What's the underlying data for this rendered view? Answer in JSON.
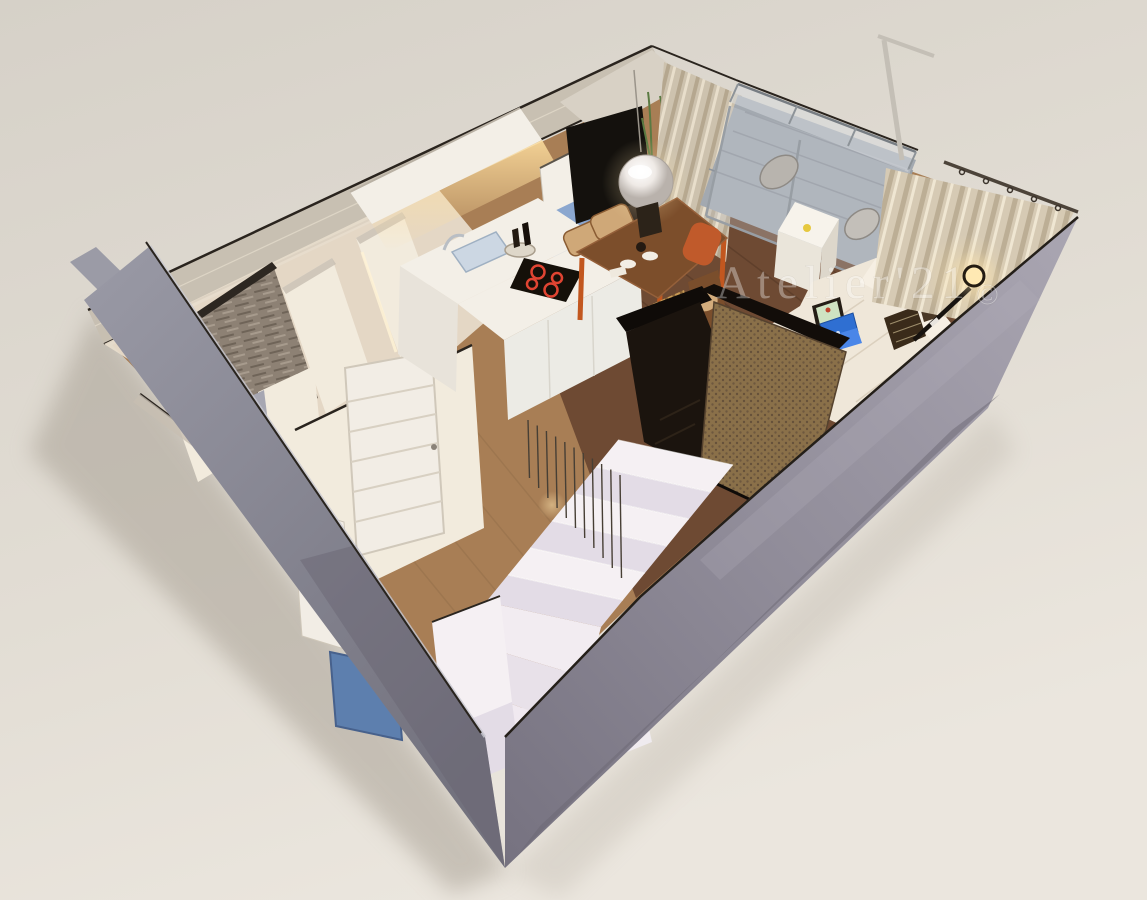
{
  "watermark": {
    "text": "Atelier'21",
    "copyright": "©"
  },
  "scene": {
    "type": "3d-floor-plan-render",
    "stairs": {
      "straight_steps": 6,
      "winder_steps": 3,
      "balusters": 11
    },
    "hob_burners": 4,
    "balcony_chairs": 2,
    "dining_chairs": 4
  },
  "palette": {
    "bg_top": "#d6d1c8",
    "bg_bottom": "#ebe6de",
    "shadow": "#a49c90",
    "floor_hall": "#a87e55",
    "floor_living": "#6e4a33",
    "balcony_deck": "#a3a9b0",
    "nw_cap": "#c7beb1",
    "wall_trim": "#2a241e",
    "inner_wall": "#e7dccb",
    "inner_wall_lit": "#f2ebdd",
    "door_white": "#f2ede5",
    "entry_mat": "#5d7fae",
    "kitchen_white": "#f3efe7",
    "kitchen_face": "#e8e3da",
    "cabinet_glow": "#ffdf9f",
    "hob": "#151009",
    "hob_ring": "#e04432",
    "sink": "#ccd7e3",
    "steel": "#b9bec4",
    "cabinet_blue": "#7f9ecc",
    "tv": "#14110d",
    "plant": "#5a7a42",
    "lamp_glow": "#ffe9b3",
    "table_top": "#7c4e2b",
    "table_leg": "#c2571f",
    "chair_tan": "#cfa878",
    "chair_dark": "#7a4e2c",
    "accent_chair": "#c05a2b",
    "sofa": "#efe7d9",
    "sofa_light": "#f6efe3",
    "pillow": "#3a2b1a",
    "laptop_blue": "#2f6fd2",
    "laptop_base": "#4a86e8",
    "frame_dark": "#241d15",
    "deck_chair": "#b8b4ae",
    "stair_white": "#f5f0f3",
    "stair_shade": "#e3dce6",
    "baluster": "#473f35",
    "enclosure_dark": "#1b140e",
    "enclosure_brown": "#8a7049",
    "outer_wall_light": "#a09caa",
    "outer_wall_dark": "#76727e",
    "watermark_color": "#ffffff"
  }
}
